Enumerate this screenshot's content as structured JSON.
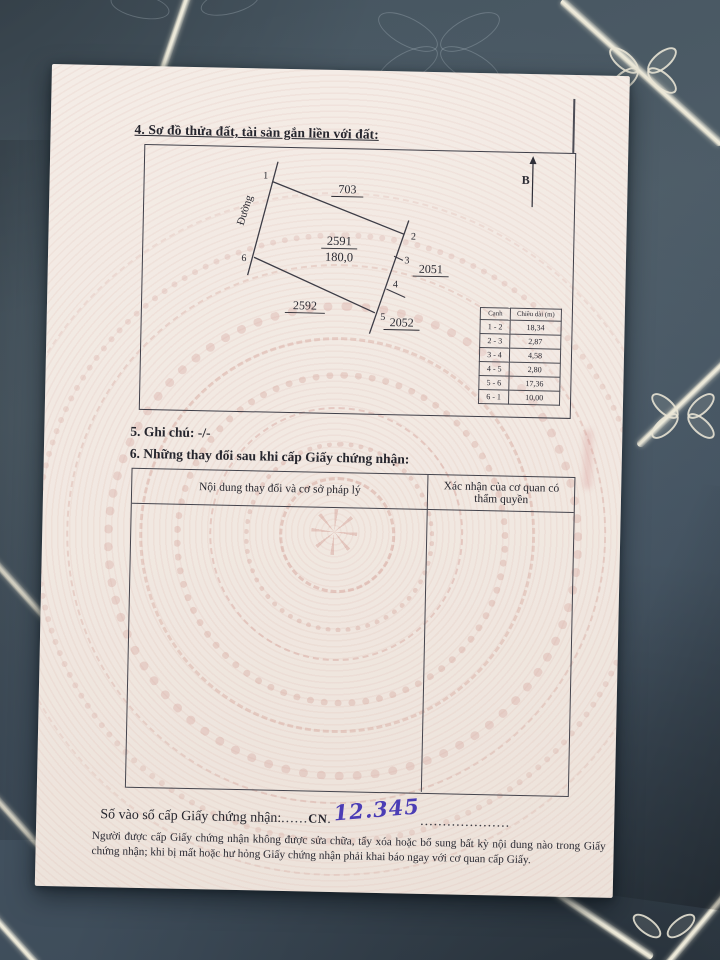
{
  "document": {
    "section4": {
      "heading": "4. Sơ đồ thửa đất, tài sản gắn liền với đất:",
      "north_label": "B",
      "road_label": "Đường",
      "parcel": {
        "number": "2591",
        "area": "180,0",
        "vertices": [
          "1",
          "2",
          "3",
          "4",
          "5",
          "6"
        ]
      },
      "neighbors": {
        "top": "703",
        "right": "2051",
        "bottom_right": "2052",
        "bottom_left": "2592"
      },
      "edge_table": {
        "headers": [
          "Cạnh",
          "Chiều dài (m)"
        ],
        "rows": [
          [
            "1 - 2",
            "18,34"
          ],
          [
            "2 - 3",
            "2,87"
          ],
          [
            "3 - 4",
            "4,58"
          ],
          [
            "4 - 5",
            "2,80"
          ],
          [
            "5 - 6",
            "17,36"
          ],
          [
            "6 - 1",
            "10,00"
          ]
        ]
      }
    },
    "section5": {
      "heading": "5. Ghi chú: -/-"
    },
    "section6": {
      "heading": "6. Những thay đổi sau khi cấp Giấy chứng nhận:",
      "columns": [
        "Nội dung thay đổi và cơ sở pháp lý",
        "Xác nhận của cơ quan có thẩm quyền"
      ]
    },
    "registry": {
      "label": "Số vào sổ cấp Giấy chứng nhận:",
      "dots_lead": "......",
      "code": "CN",
      "dots_mid": ".",
      "number": "12.345",
      "dots_trail": "...................."
    },
    "footer": {
      "text": "Người được cấp Giấy chứng nhận không được sửa chữa, tẩy xóa hoặc bổ sung bất kỳ nội dung nào trong Giấy chứng nhận; khi bị mất hoặc hư hỏng Giấy chứng nhận phải khai báo ngay với cơ quan cấp Giấy."
    }
  },
  "colors": {
    "paper": "#f2eae3",
    "ink": "#26262e",
    "table_line": "#4a4a52",
    "handwriting_blue": "#4b3db5",
    "watermark_pink": "#cf968c",
    "bedding": "#46555f",
    "quilt_stripe": "#e8e4d3"
  }
}
